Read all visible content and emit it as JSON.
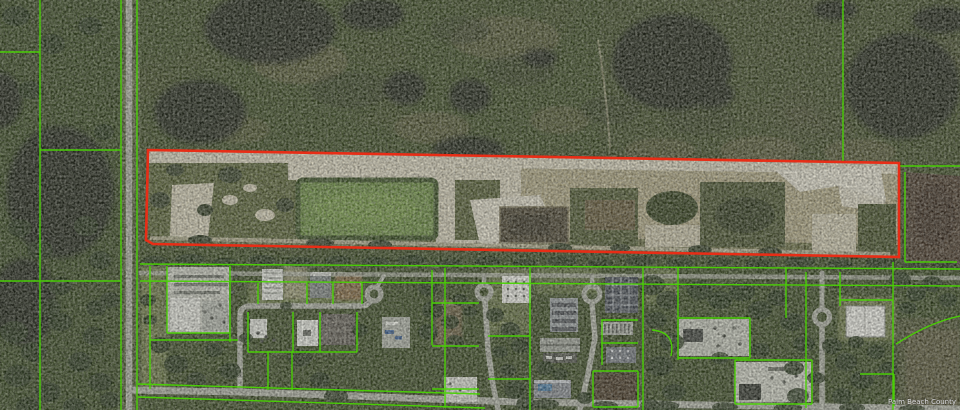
{
  "map": {
    "watermark": "Palm Beach County",
    "colors": {
      "subject_parcel_outline": "#e82d16",
      "parcel_boundary_line": "#49d402",
      "road": "#b4b7aa"
    },
    "subject_parcel": {
      "points": "148,150 899,163 899,257 153,244 146,240"
    }
  }
}
